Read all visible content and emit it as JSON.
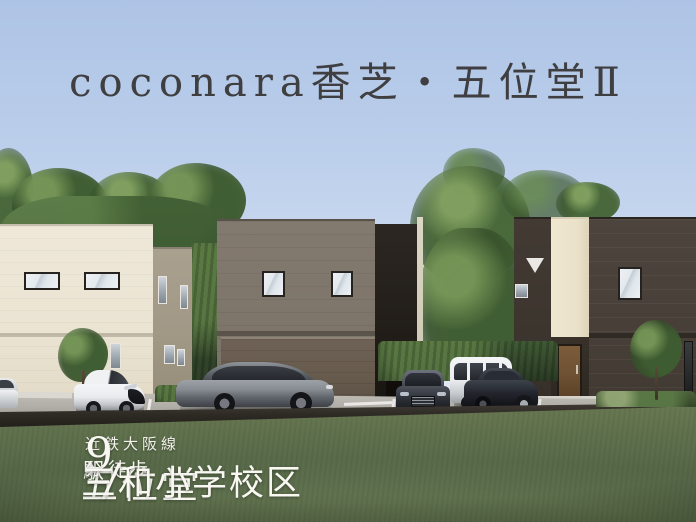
{
  "meta": {
    "width": 696,
    "height": 522
  },
  "title": {
    "text": "coconara香芝・五位堂Ⅱ"
  },
  "access": {
    "rail_line": "近鉄大阪線",
    "station_name": "五位堂",
    "station_suffix": "駅",
    "walk_label": "徒歩",
    "walk_minutes": "9",
    "minutes_unit": "分",
    "separator": "/",
    "school_district": "三和小学校区"
  },
  "palette": {
    "sky_top": "#aec4e6",
    "sky_horizon": "#eef2f8",
    "title_text": "#3f3f41",
    "footer_text": "#f8f7f2",
    "tree_green": "#44623a",
    "grass": "#5b6d4c",
    "house_left_cream": "#ece5d5",
    "house_left_side_taupe": "#a59b8a",
    "house_mid_brown": "#7e756b",
    "house_mid_garage": "#695d51",
    "house_mid_dark_panel": "#26211d",
    "house_mid_pillar": "#d9d2c0",
    "house_right_dark": "#4a423b",
    "house_right_cream_accent": "#ece3cc",
    "house_right_door": "#6f5233",
    "road_pavement": "#b3b0aa",
    "road_edge_dark": "#2c2823",
    "car_gray": "#84898f",
    "car_white": "#eef0f2",
    "car_dark": "#23262d"
  }
}
